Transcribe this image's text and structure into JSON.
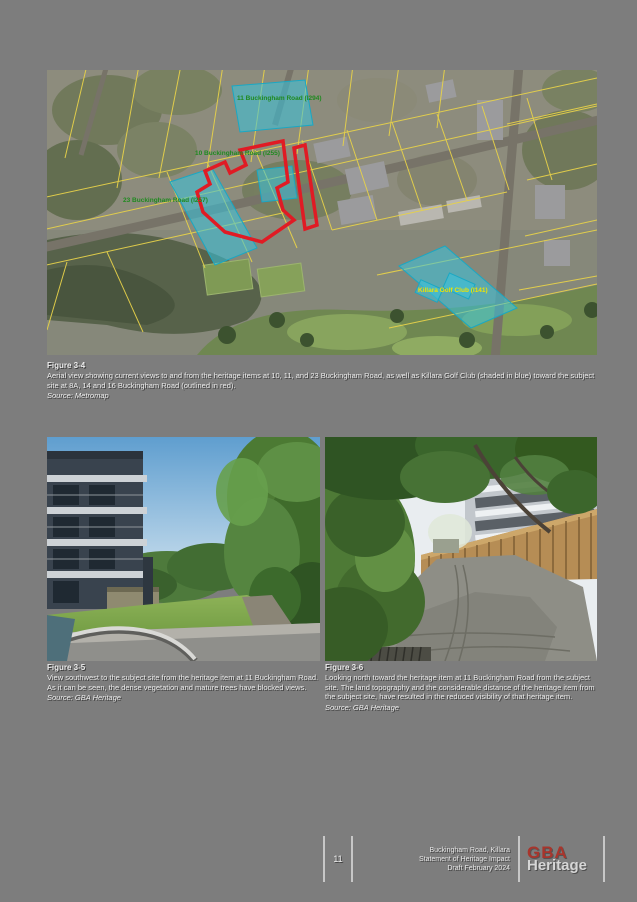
{
  "page": {
    "background_color": "#7d7d7d"
  },
  "map": {
    "labels": {
      "item11": "11 Buckingham Road (I294)",
      "item10": "10 Buckingham Road (I255)",
      "item23": "23 Buckingham Road (I257)",
      "golf_club": "Killara Golf Club (I141)"
    },
    "colors": {
      "heritage_label_green": "#1f8a1f",
      "golf_label_yellow": "#f0e400",
      "shaded_overlay_blue": "#38c4de",
      "subject_outline_red": "#e01b24",
      "cadastre_line_yellow": "#e6d14a"
    }
  },
  "figure_aerial": {
    "heading": "Figure 3-4",
    "caption": "Aerial view showing current views to and from the heritage items at 10, 11, and 23 Buckingham Road, as well as Killara Golf Club (shaded in blue) toward the subject site at 8A, 14 and 16 Buckingham Road (outlined in red).",
    "source": "Source: Metromap"
  },
  "figure_left_photo": {
    "heading": "Figure 3-5",
    "caption": "View southwest to the subject site from the heritage item at 11 Buckingham Road. As it can be seen, the dense vegetation and mature trees have blocked views.",
    "source": "Source: GBA Heritage"
  },
  "figure_right_photo": {
    "heading": "Figure 3-6",
    "caption": "Looking north toward the heritage item at 11 Buckingham Road from the subject site. The land topography and the considerable distance of the heritage item from the subject site, have resulted in the reduced visibility of that heritage item.",
    "source": "Source: GBA Heritage"
  },
  "footer": {
    "page_number": "11",
    "doc_line1": "Buckingham Road, Killara",
    "doc_line2": "Statement of Heritage Impact",
    "doc_line3": "Draft February 2024",
    "logo_top": "GBA",
    "logo_bottom": "Heritage"
  }
}
